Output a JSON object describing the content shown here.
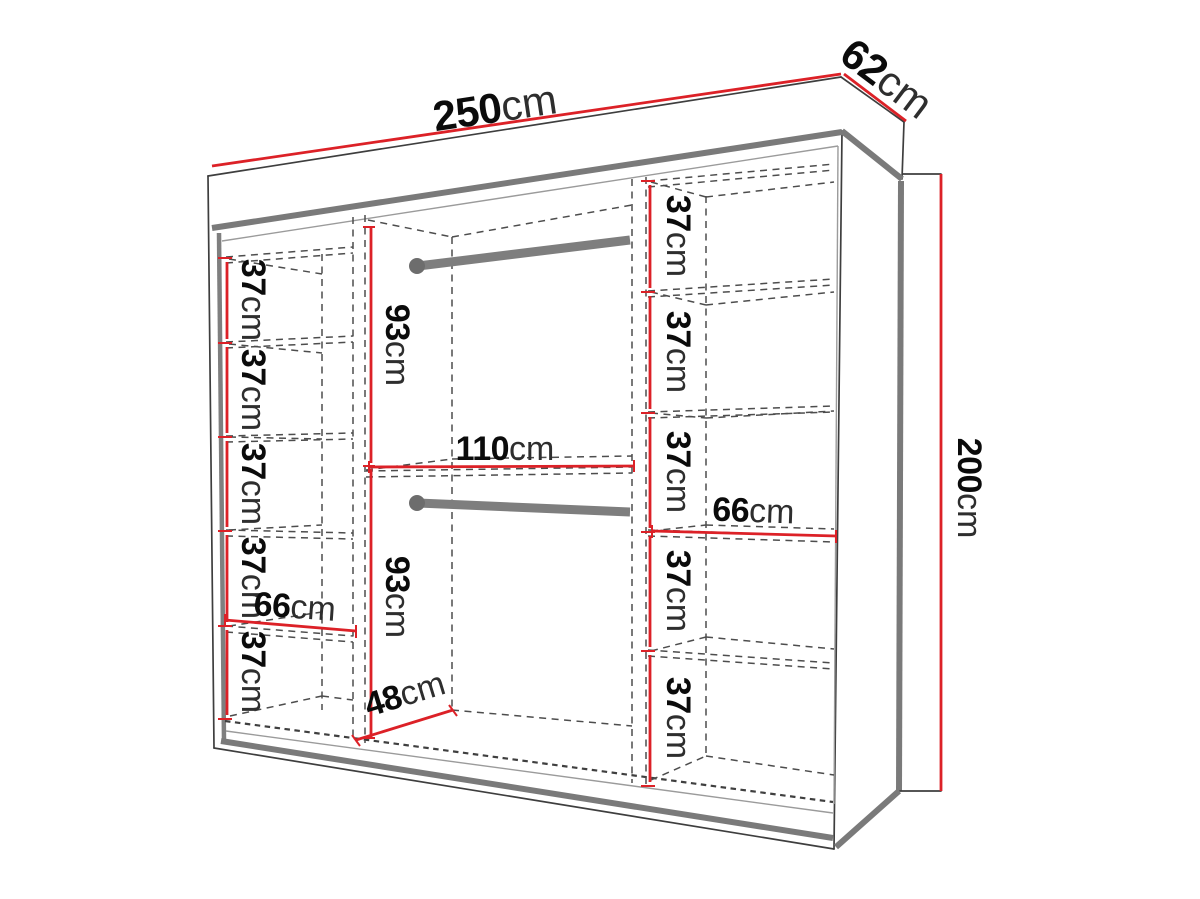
{
  "diagram": {
    "kind": "wardrobe-dimension-diagram",
    "colors": {
      "dimension_line": "#dc2127",
      "outline": "#3e3e3e",
      "panel_gray": "#7a7a7a",
      "dashed_interior": "#4d4d4d",
      "background": "#ffffff",
      "label_number": "#0b0b0b",
      "label_unit": "#2e2e2e"
    },
    "dimensions": {
      "overall": {
        "width": {
          "value": "250",
          "unit": "cm"
        },
        "depth": {
          "value": "62",
          "unit": "cm"
        },
        "height": {
          "value": "200",
          "unit": "cm"
        }
      },
      "left_column": {
        "compartments": [
          {
            "value": "37",
            "unit": "cm"
          },
          {
            "value": "37",
            "unit": "cm"
          },
          {
            "value": "37",
            "unit": "cm"
          },
          {
            "value": "37",
            "unit": "cm"
          },
          {
            "value": "37",
            "unit": "cm"
          }
        ],
        "shelf_width": {
          "value": "66",
          "unit": "cm"
        }
      },
      "middle_section": {
        "upper_height": {
          "value": "93",
          "unit": "cm"
        },
        "width": {
          "value": "110",
          "unit": "cm"
        },
        "lower_height": {
          "value": "93",
          "unit": "cm"
        },
        "depth": {
          "value": "48",
          "unit": "cm"
        }
      },
      "right_column": {
        "compartments": [
          {
            "value": "37",
            "unit": "cm"
          },
          {
            "value": "37",
            "unit": "cm"
          },
          {
            "value": "37",
            "unit": "cm"
          },
          {
            "value": "37",
            "unit": "cm"
          },
          {
            "value": "37",
            "unit": "cm"
          }
        ],
        "shelf_width": {
          "value": "66",
          "unit": "cm"
        }
      }
    }
  }
}
